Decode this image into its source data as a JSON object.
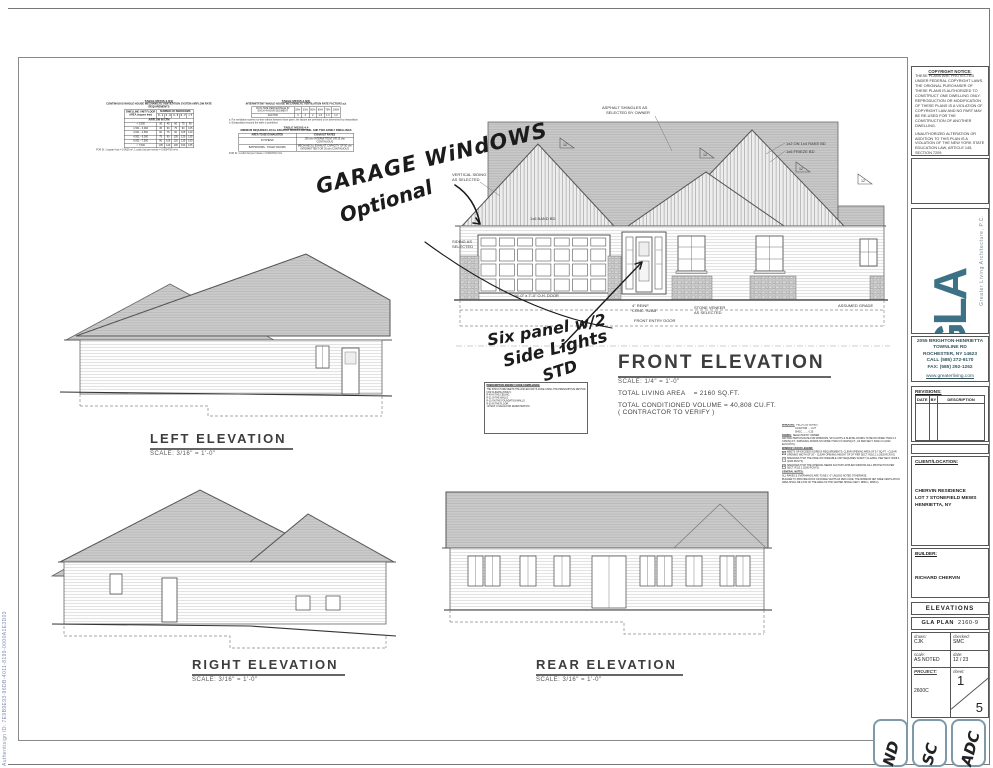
{
  "page": {
    "watermark": "Authentisign ID: 7E9B9E93-96DB-4011-8199-0000A1E3D03"
  },
  "tables": {
    "t1": {
      "title": "TABLE M1505.4.3(1)",
      "subtitle": "CONTINUOUS WHOLE-HOUSE MECHANICAL VENTILATION SYSTEM AIRFLOW RATE REQUIREMENTS",
      "area_header": "DWELLING UNIT FLOOR AREA (square feet)",
      "group_header": "NUMBER OF BEDROOMS",
      "bed_cols": [
        "0 - 1",
        "2 - 3",
        "4 - 5",
        "6 - 7",
        "> 7"
      ],
      "sub_header": "AIRFLOW IN CFM",
      "rows": [
        [
          "< 1,500",
          "30",
          "45",
          "60",
          "75",
          "90"
        ],
        [
          "1,501 - 3,000",
          "45",
          "60",
          "75",
          "90",
          "105"
        ],
        [
          "3,001 - 4,500",
          "60",
          "75",
          "90",
          "105",
          "120"
        ],
        [
          "4,501 - 6,000",
          "75",
          "90",
          "105",
          "120",
          "135"
        ],
        [
          "6,001 - 7,500",
          "90",
          "105",
          "120",
          "135",
          "150"
        ],
        [
          "> 7,500",
          "105",
          "120",
          "135",
          "150",
          "165"
        ]
      ],
      "foot": "FOR SI: 1 square foot = 0.0929 m², 1 cubic foot per minute = 0.0004719 m³/s."
    },
    "t2": {
      "title": "TABLE M1505.4.3(2)",
      "subtitle": "INTERMITTENT WHOLE-HOUSE MECHANICAL VENTILATION RATE FACTORS a,b",
      "rows": [
        [
          "RUN-TIME PERCENTAGE IN EACH 4-HOUR SEGMENT",
          "25%",
          "33%",
          "50%",
          "66%",
          "75%",
          "100%"
        ],
        [
          "FACTOR",
          "4",
          "3",
          "2",
          "1.5",
          "1.3",
          "1.0"
        ]
      ],
      "notes": [
        "a. For ventilation system run-time values between those given, the factors are permitted to be determined by interpolation.",
        "b. Extrapolation beyond the table is prohibited."
      ]
    },
    "t3": {
      "title": "TABLE M1505.4.4",
      "subtitle": "MINIMUM REQUIRED LOCAL EXHAUST RATES FOR ONE- AND TWO-FAMILY DWELLINGS",
      "headers": [
        "AREA TO BE EXHAUSTED",
        "EXHAUST RATES"
      ],
      "rows": [
        [
          "KITCHENS",
          "100 cfm INTERMITTENT OR 25 cfm CONTINUOUS"
        ],
        [
          "BATHROOMS - TOILET ROOMS",
          "MECHANICAL EXHAUST CAPACITY OF 50 cfm INTERMITTENT OR 20 cfm CONTINUOUS"
        ]
      ],
      "foot": "FOR SI: 1 cubic foot per minute = 0.0004719 m³/s."
    }
  },
  "handwritten": {
    "garage_l1": "GARAGE WiNdOWS",
    "garage_l2": "Optional",
    "sp_l1": "Six panel w/2",
    "sp_l2": "Side Lights",
    "sp_l3": "STD"
  },
  "front": {
    "title": "FRONT ELEVATION",
    "scale": "SCALE:   1/4\" = 1'-0\"",
    "living_label": "TOTAL LIVING AREA",
    "living_value": "=  2160 SQ.FT.",
    "volume_label": "TOTAL CONDITIONED VOLUME  =",
    "volume_value": "40,808 CU.FT.",
    "verify": "( CONTRACTOR TO VERIFY )",
    "ann": {
      "asphalt_l1": "ASPHALT SHINGLES AS",
      "asphalt_l2": "SELECTED BY OWNER",
      "rake": "1x2 ON 1x4 RAKE BD",
      "frieze": "1x6 FRIEZE BD",
      "band": "1x6 BAND BD",
      "vert_l1": "VERTICAL SIDING",
      "vert_l2": "AS SELECTED",
      "siding_l1": "SIDING AS",
      "siding_l2": "SELECTED",
      "garage_door": "16'-0\" x 7'-0\" O.H. DOOR",
      "slab_l1": "4\" REINF.",
      "slab_l2": "CONC. SLAB",
      "entry": "FRONT ENTRY DOOR",
      "stone_l1": "STONE VENEER",
      "stone_l2": "AS SELECTED",
      "grade": "ASSUMED GRADE",
      "pitch": "12"
    }
  },
  "left_elev": {
    "title": "LEFT ELEVATION",
    "scale": "SCALE:  3/16\" = 1'-0\""
  },
  "right_elev": {
    "title": "RIGHT ELEVATION",
    "scale": "SCALE:  3/16\" = 1'-0\""
  },
  "rear_elev": {
    "title": "REAR ELEVATION",
    "scale": "SCALE:  3/16\" = 1'-0\""
  },
  "energy": {
    "title": "PRESCRIPTIVE ENERGY CODE COMPLIANCE:",
    "lines": [
      "THE STRUCTURE MEETS THE 2020 ECCCNYS CODE USING THE PRESCRIPTIVE METHOD FOR CLIMATE ZONE 5:",
      "R-49 IN THE CEILING",
      "R-21 IN THE WALLS",
      "R-10 ON THE FOUNDATION WALLS",
      "R-30 IN THE FLOOR",
      ".30 MAX U-VALUE FOR FENESTRATION"
    ]
  },
  "specs": {
    "windows_label": "WINDOWS:",
    "windows_value": "PELLA 250 SERIES",
    "ufactor": "U-FACTOR  ....  0.27",
    "shgc": "SHGC  ........  0.25",
    "doors_label": "DOORS:",
    "doors_value": "SELECTED BY OWNER",
    "infiltration": "AIR INFILTRATION RATE FOR WINDOWS, SKYLIGHTS & SLIDING DOORS TO BE NO MORE THAN 0.3 CFM/SQ.FT.; SWINGING DOORS NO MORE THAN 0.5 CFM/SQ.FT., AS PER SECT. R402.4.3 (2020 ECCCNYS).",
    "legend_title": "WINDOW / DOOR LEGEND:",
    "legend": [
      {
        "symbol": "E",
        "text": "MEETS OR EXCEEDS EGRESS REQUIREMENTS: CLEAR OPENING AREA OF 5.7 SQ.FT. - CLEAR OPENING WIDTH OF 20\" - CLEAR OPENING HEIGHT OF 24\" PER SECT. R310.2.1 (2020 RCNYS)"
      },
      {
        "symbol": "T",
        "text": "SPECIFIES THAT THE PANE OR OPERABLE UNIT REQUIRES SAFETY GLAZING, PER SECT. R308.4 (2020 RCNYS)"
      },
      {
        "symbol": "FP",
        "text": "SPECIFIES THAT THE OPENING NEEDS FACTORY-APPLIED WINDOW FALL PROTECTION PER SECT. R312.2 (2020 RCNYS)"
      }
    ],
    "general_title": "GENERAL NOTES:",
    "general": [
      "ALL RAKES & OVERHANGS ARE TO BE 1'-0\" UNLESS NOTED OTHERWISE.",
      "BUILDER TO PROVIDE ROOF OR RIDGE VENTS AS PER CODE; THE MINIMUM NET FREE VENTILATION AREA SHALL BE 1/150 OF THE AREA OF THE VENTED SPACE (SECT. R806.1, R806.2)."
    ]
  },
  "titleblock": {
    "copyright_title": "COPYRIGHT NOTICE:",
    "copyright_paras": [
      "THESE PLANS ARE PROTECTED UNDER FEDERAL COPYRIGHT LAWS. THE ORIGINAL PURCHASER OF THESE PLANS IS AUTHORIZED TO CONSTRUCT ONE DWELLING ONLY. REPRODUCTION OR MODIFICATION OF THESE PLANS IS A VIOLATION OF COPYRIGHT LAW AND NO PART MAY BE RE-USED FOR THE CONSTRUCTION OF ANOTHER DWELLING.",
      "UNAUTHORIZED ALTERATION OR ADDITION TO THIS PLAN IS A VIOLATION OF THE NEW YORK STATE EDUCATION LAW, ARTICLE 145, SECTION 7209.",
      "COPYRIGHT © ALL RIGHTS RESERVED. GREATER LIVING ARCHITECTURE, P.C."
    ],
    "logo_letters": "GLA",
    "logo_side_text": "Greater Living Architecture, P.C.",
    "address_lines": [
      "2055 BRIGHTON-HENRIETTA",
      "TOWNLINE RD",
      "ROCHESTER, NY  14623",
      "CALL (585) 272-9170",
      "FAX: (585) 292-1262"
    ],
    "website": "www.greaterliving.com",
    "revisions_title": "REVISIONS:",
    "rev_headers": [
      "DATE",
      "BY",
      "DESCRIPTION"
    ],
    "client_title": "CLIENT/LOCATION:",
    "client_lines": [
      "CHERVIN RESIDENCE",
      "LOT 7 STONEFIELD MEWS",
      "HENRIETTA, NY"
    ],
    "builder_title": "BUILDER:",
    "builder_name": "RICHARD CHERVIN",
    "sheet_title": "ELEVATIONS",
    "plan_label": "GLA PLAN",
    "plan_number": "2160-9",
    "drawn_label": "drawn:",
    "drawn_value": "CJK",
    "checked_label": "checked:",
    "checked_value": "SMC",
    "scale_label": "scale:",
    "scale_value": "AS NOTED",
    "date_label": "date:",
    "date_value": "12 / 23",
    "project_label": "PROJECT:",
    "project_value": "2600C",
    "sheet_label": "sheet:",
    "sheet_num": "1",
    "sheet_total": "5",
    "stamps": [
      "ND",
      "SC",
      "ADC"
    ]
  }
}
